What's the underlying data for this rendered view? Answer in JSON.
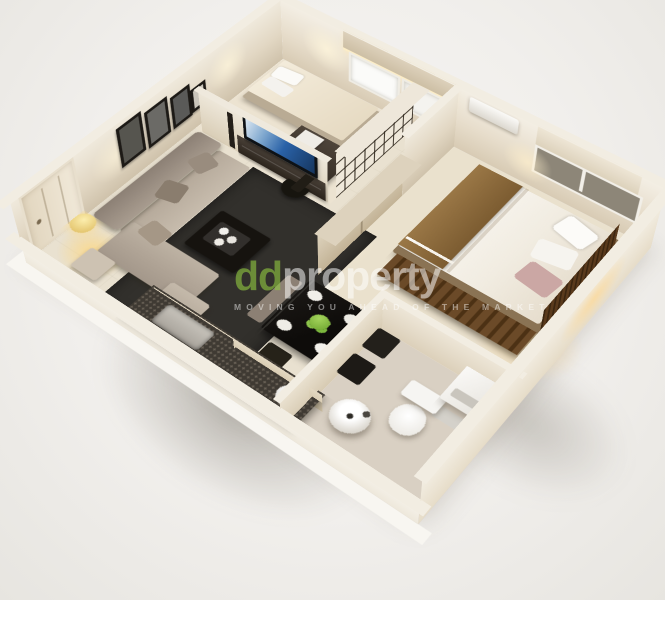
{
  "watermark": {
    "logo_prefix": "dd",
    "logo_suffix": "property",
    "tagline": "MOVING YOU AHEAD OF THE MARKET",
    "logo_prefix_color": "#8fc641",
    "logo_text_color": "#ffffff"
  },
  "palette": {
    "background": "#f2f1ee",
    "exterior_wall": "#f3efe7",
    "interior_wall": "#e9e2d4",
    "wall_shadow": "#cfc5b2",
    "floor_main": "#e9e1d0",
    "floor_bathroom": "#d9d0c3",
    "rug": "#32302c",
    "dark_wood": "#54371f",
    "brown_blanket": "#8f6b3e",
    "sofa": "#9d9186",
    "tv_screen_blue": "#2a62a8",
    "lamp_glow": "#ffdf9e",
    "fruit_green": "#7db93e",
    "table_black": "#12100e",
    "white_fixture": "#f7f6f3"
  },
  "scene": {
    "type": "3d-isometric-floor-plan",
    "subject": "One-bedroom apartment 3D floor plan render",
    "rooms": [
      {
        "name": "Living room",
        "items": [
          "sectional-sofa",
          "throw-pillows",
          "coffee-table",
          "tea-set",
          "area-rug",
          "ottoman",
          "floor-lamp",
          "side-table",
          "picture-frames",
          "tv-console",
          "flat-screen-tv",
          "entry-door"
        ]
      },
      {
        "name": "Study bedroom",
        "items": [
          "single-bed",
          "pillows",
          "desk",
          "office-chair",
          "computer",
          "overhead-cabinets",
          "window",
          "cube-shelf"
        ]
      },
      {
        "name": "Master bedroom",
        "items": [
          "double-bed",
          "brown-blanket",
          "pillows",
          "slatted-headboard",
          "storage-bench",
          "wardrobe",
          "air-conditioner",
          "window-blind",
          "bedside-lamp-glow"
        ]
      },
      {
        "name": "Bathroom",
        "items": [
          "washing-machine",
          "toilet",
          "round-basin"
        ]
      },
      {
        "name": "Kitchen",
        "items": [
          "granite-counter",
          "sink"
        ]
      },
      {
        "name": "Dining area",
        "items": [
          "black-dining-table",
          "place-settings",
          "green-centerpiece",
          "dining-chairs",
          "bench"
        ]
      }
    ]
  }
}
